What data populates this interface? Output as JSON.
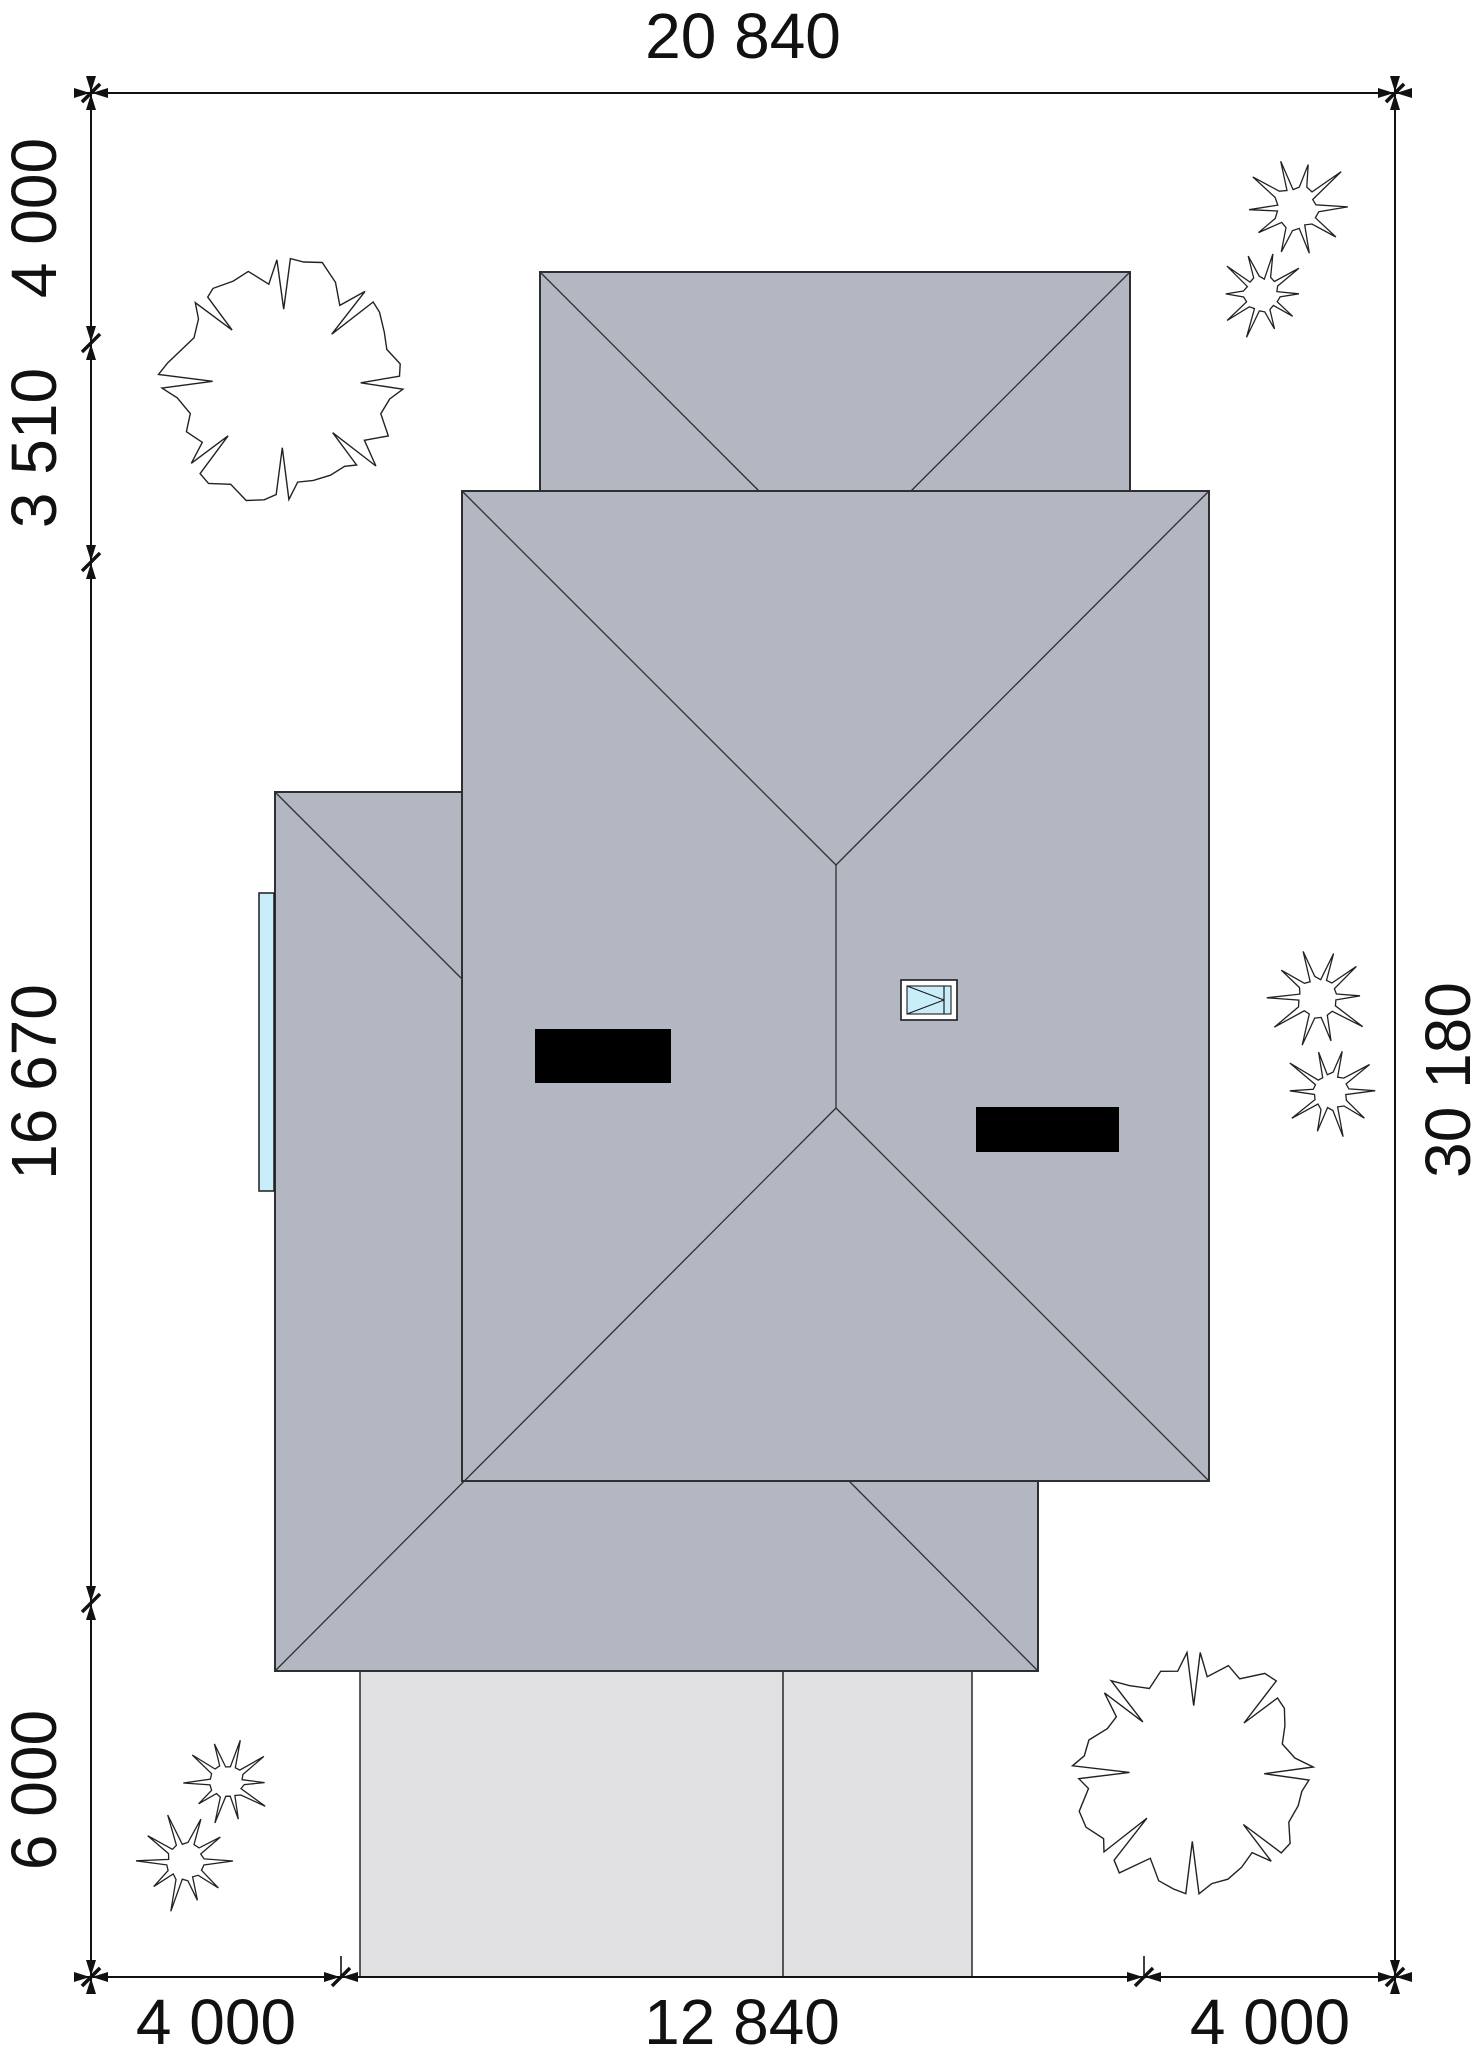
{
  "title": "house-site-roof-plan",
  "colors": {
    "paper": "#ffffff",
    "roof_fill": "#b3b7c1",
    "roof_line": "#2e2e33",
    "outline": "#1c1c1f",
    "driveway_fill": "#e1e1e4",
    "chimney_fill": "#000000",
    "glass_fill": "#c9edf9",
    "dim_color": "#111111"
  },
  "dims": {
    "font_size": 64,
    "top": {
      "label": "20 840",
      "x": 743,
      "y": 58
    },
    "bottom": [
      {
        "label": "4 000",
        "x": 216
      },
      {
        "label": "12 840",
        "x": 742
      },
      {
        "label": "4 000",
        "x": 1270
      }
    ],
    "bottom_baseline_y": 2044,
    "left": [
      {
        "label": "4 000",
        "y": 218
      },
      {
        "label": "3 510",
        "y": 448
      },
      {
        "label": "16 670",
        "y": 1082
      },
      {
        "label": "6 000",
        "y": 1790
      }
    ],
    "left_baseline_x": 56,
    "right": [
      {
        "label": "30 180",
        "y": 1080
      }
    ],
    "right_baseline_x": 1470,
    "lines": {
      "top": {
        "x1": 85,
        "y1": 93,
        "x2": 1403,
        "y2": 93
      },
      "bottom": {
        "x1": 85,
        "y1": 1977,
        "x2": 1403,
        "y2": 1977
      },
      "left": {
        "x1": 91,
        "y1": 85,
        "x2": 91,
        "y2": 1990
      },
      "right": {
        "x1": 1395,
        "y1": 85,
        "x2": 1395,
        "y2": 1990
      }
    },
    "ticks": {
      "top": {
        "y": 93,
        "xs": [
          91,
          1395
        ]
      },
      "bottom": {
        "y": 1977,
        "xs": [
          91,
          341,
          1144,
          1395
        ]
      },
      "left": {
        "x": 91,
        "ys": [
          93,
          343,
          562,
          1603,
          1977
        ]
      },
      "right": {
        "x": 1395,
        "ys": [
          93,
          1977
        ]
      }
    },
    "stubs": [
      {
        "x1": 341,
        "y1": 1977,
        "x2": 341,
        "y2": 1956
      },
      {
        "x1": 1144,
        "y1": 1977,
        "x2": 1144,
        "y2": 1956
      }
    ]
  },
  "plan": {
    "canvas": {
      "w": 1484,
      "h": 2068
    },
    "driveway": {
      "x": 360,
      "y": 1670,
      "w": 612,
      "h": 307,
      "divider_x": 783
    },
    "roof": {
      "garage_rect": {
        "x": 540,
        "y": 272,
        "w": 590,
        "h": 219
      },
      "lower_poly": "275,792 462,792 462,1481 1038,1481 1038,1671 275,1671",
      "main_rect": {
        "x": 462,
        "y": 491,
        "w": 747,
        "h": 990
      },
      "hip_lines": [
        [
          540,
          272,
          759,
          491
        ],
        [
          1130,
          272,
          911,
          491
        ],
        [
          462,
          491,
          836,
          865
        ],
        [
          1209,
          491,
          836,
          865
        ],
        [
          836,
          865,
          836,
          1108
        ],
        [
          836,
          1108,
          1209,
          1481
        ],
        [
          836,
          1108,
          275,
          1671
        ],
        [
          849,
          1481,
          1038,
          1671
        ],
        [
          275,
          792,
          461,
          978
        ]
      ]
    },
    "chimneys": [
      {
        "x": 535,
        "y": 1029,
        "w": 136,
        "h": 54
      },
      {
        "x": 976,
        "y": 1107,
        "w": 143,
        "h": 45
      }
    ],
    "skylight": {
      "outer": {
        "x": 901,
        "y": 980,
        "w": 56,
        "h": 40
      },
      "glass": {
        "x": 907,
        "y": 986,
        "w": 44,
        "h": 28
      },
      "sash_x": 944
    },
    "window_strip": {
      "x": 259,
      "y": 893,
      "w": 15,
      "h": 298
    },
    "trees": [
      {
        "cx": 283,
        "cy": 382,
        "r": 122,
        "seed": 7
      },
      {
        "cx": 1193,
        "cy": 1773,
        "r": 120,
        "seed": 11
      }
    ],
    "shrubs": [
      {
        "cx": 1296,
        "cy": 208,
        "r": 54,
        "seed": 2
      },
      {
        "cx": 1262,
        "cy": 294,
        "r": 44,
        "seed": 3
      },
      {
        "cx": 1318,
        "cy": 997,
        "r": 50,
        "seed": 4
      },
      {
        "cx": 1330,
        "cy": 1092,
        "r": 46,
        "seed": 5
      },
      {
        "cx": 228,
        "cy": 1782,
        "r": 42,
        "seed": 6
      },
      {
        "cx": 185,
        "cy": 1862,
        "r": 48,
        "seed": 8
      }
    ]
  }
}
